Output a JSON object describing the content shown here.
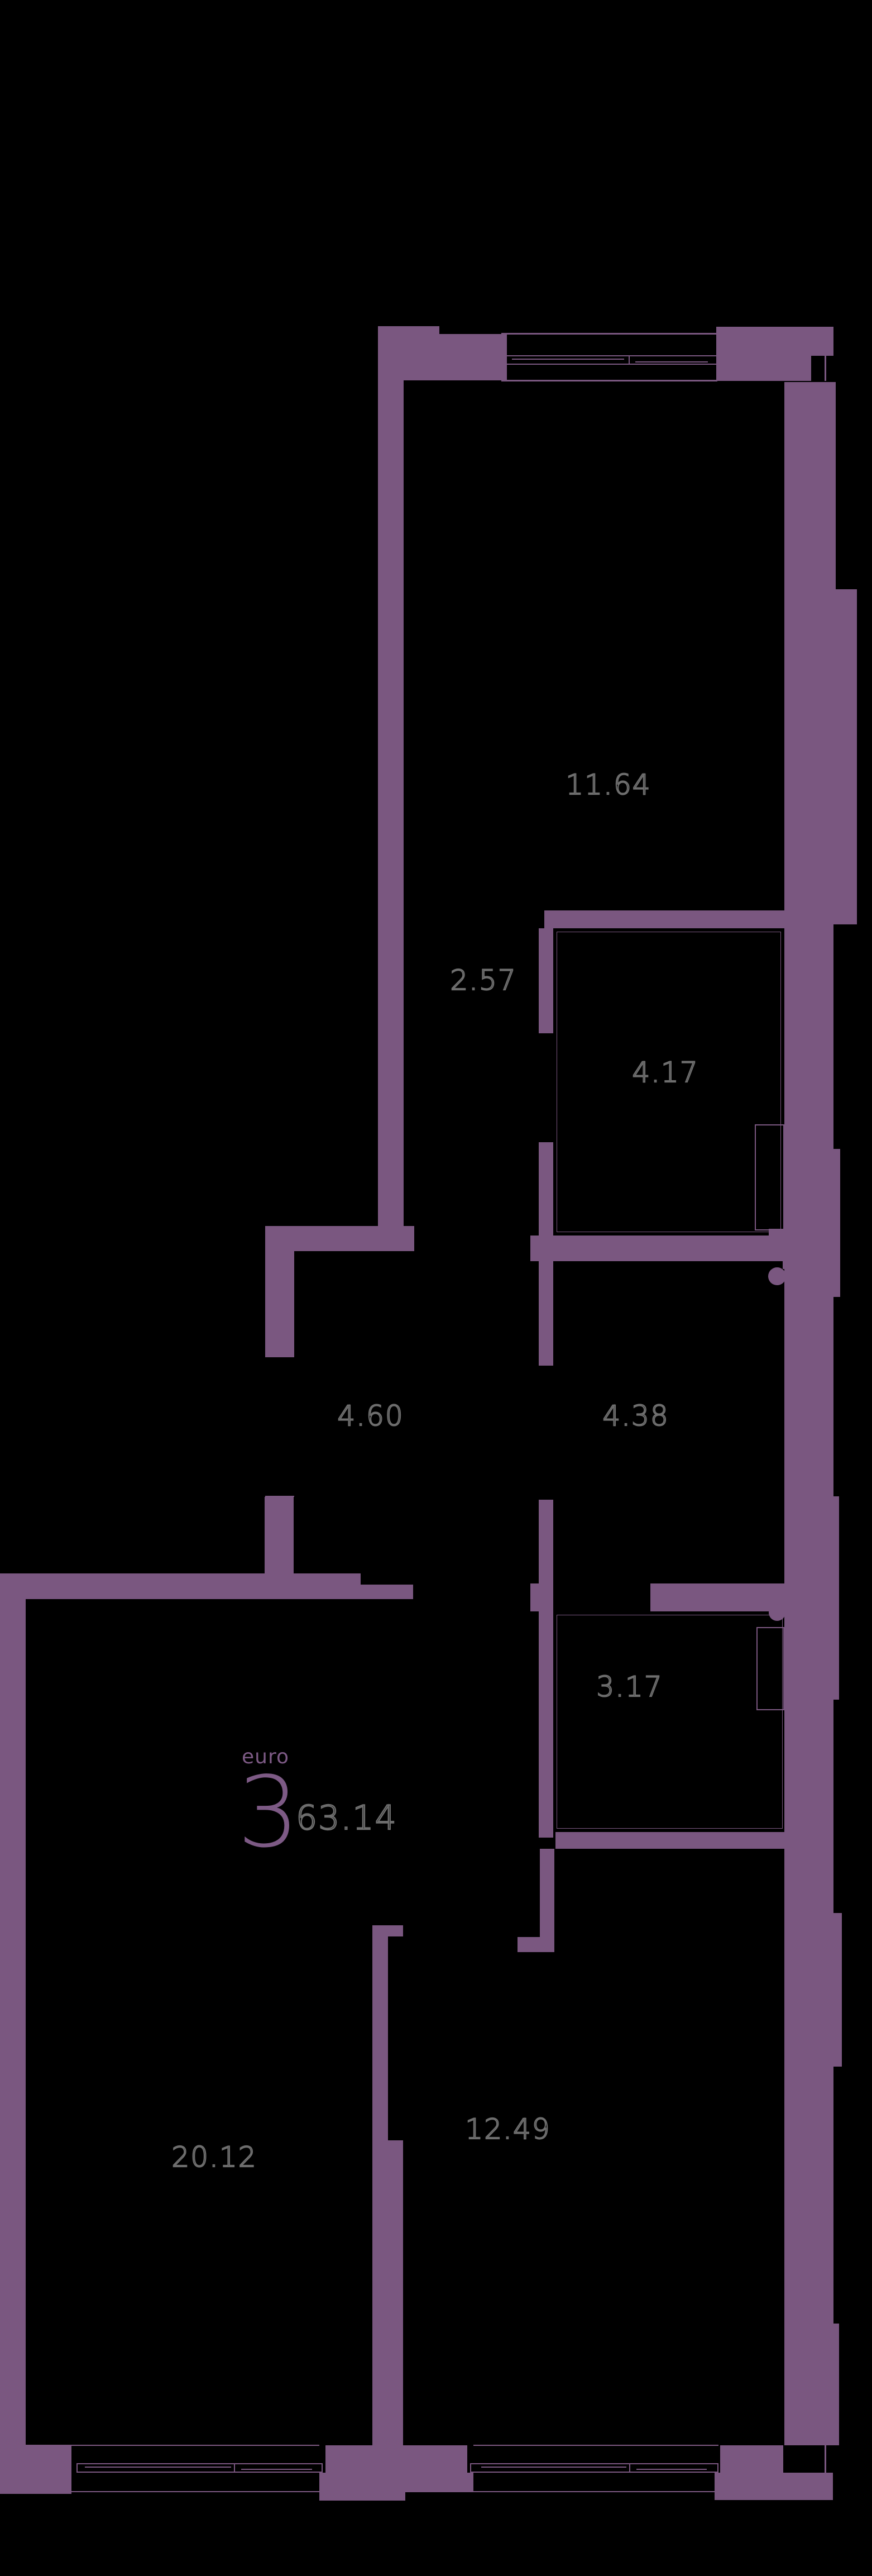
{
  "unit": {
    "type_label": "euro",
    "rooms_count": "3",
    "total_area": "63.14"
  },
  "rooms": [
    {
      "id": "room-11-64",
      "area": "11.64"
    },
    {
      "id": "room-2-57",
      "area": "2.57"
    },
    {
      "id": "room-4-17",
      "area": "4.17"
    },
    {
      "id": "room-4-60",
      "area": "4.60"
    },
    {
      "id": "room-4-38",
      "area": "4.38"
    },
    {
      "id": "room-3-17",
      "area": "3.17"
    },
    {
      "id": "room-20-12",
      "area": "20.12"
    },
    {
      "id": "room-12-49",
      "area": "12.49"
    }
  ],
  "colors": {
    "background": "#000000",
    "wall": "#7A5780",
    "unit_accent": "#7D5A85",
    "label_outline": "#6E6E6E"
  }
}
